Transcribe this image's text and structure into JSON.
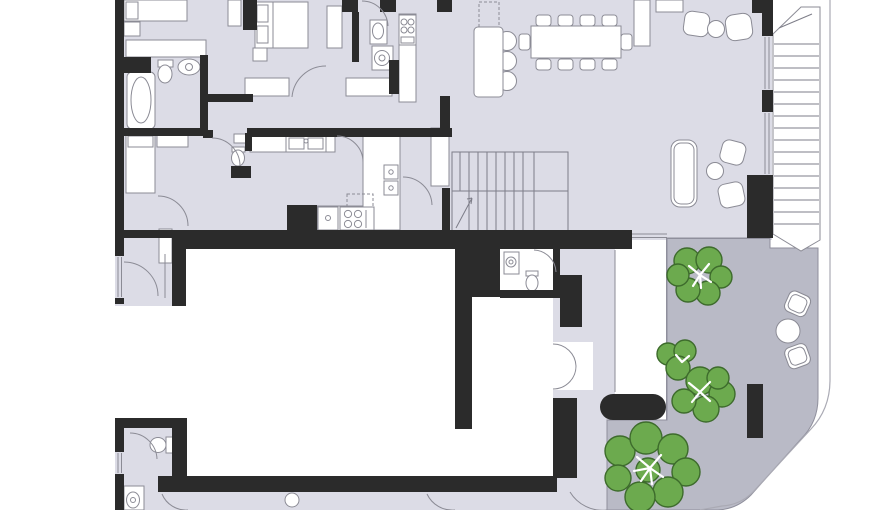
{
  "scene": "residential-apartment-floor-plan",
  "colors": {
    "paper": "#ffffff",
    "floor": "#dcdce6",
    "wall": "#2b2b2b",
    "terrace": "#b9bac6",
    "terraceEdge": "#8f8f9c",
    "tree": "#6caa4e",
    "treeline": "#3d6b2c",
    "line": "#8b8b95",
    "stairline": "#7d7d88",
    "outerline": "#aaaab4",
    "hatch": "#3a3a3a"
  },
  "legend": {
    "rooms": [
      "bedroom",
      "bedroom",
      "bedroom",
      "bathroom",
      "wc",
      "wc",
      "laundry",
      "kitchen",
      "hallway",
      "stair-hall",
      "living-dining-room",
      "vestibule",
      "corridor",
      "terrace",
      "void"
    ],
    "furniture": [
      "bed",
      "wardrobe",
      "bathtub",
      "washbasin",
      "toilet",
      "washing-machine",
      "sink",
      "cooktop",
      "oven",
      "dishwasher",
      "fridge",
      "kitchen-island",
      "bar-stool",
      "dining-table",
      "dining-chair",
      "armchair",
      "coffee-table",
      "sofa",
      "terrace-chair",
      "terrace-table",
      "bench",
      "tree",
      "staircase",
      "louver-screen"
    ]
  }
}
